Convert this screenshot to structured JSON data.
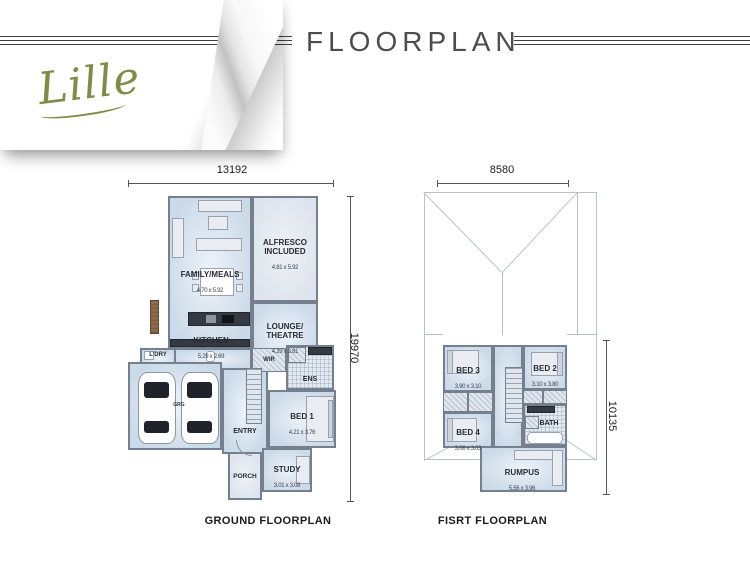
{
  "header": {
    "logo": "Lille",
    "title": "FLOORPLAN"
  },
  "ground": {
    "caption": "GROUND FLOORPLAN",
    "dim_width": "13192",
    "dim_height": "19970",
    "rooms": {
      "family": {
        "name": "FAMILY/MEALS",
        "dim": "4.70 x 5.92"
      },
      "alfresco": {
        "name": "ALFRESCO\nINCLUDED",
        "dim": "4.81 x 5.92"
      },
      "lounge": {
        "name": "LOUNGE/\nTHEATRE",
        "dim": "4.29 x 3.81"
      },
      "kitchen": {
        "name": "KITCHEN",
        "dim": "5.29 x 2.69"
      },
      "ldry": {
        "name": "L'DRY"
      },
      "wir": {
        "name": "WIR"
      },
      "ens": {
        "name": "ENS"
      },
      "bed1": {
        "name": "BED 1",
        "dim": "4.21 x 3.76"
      },
      "entry": {
        "name": "ENTRY"
      },
      "study": {
        "name": "STUDY",
        "dim": "3.01 x 3.08"
      },
      "porch": {
        "name": "PORCH"
      },
      "garage": {
        "name": "GRG"
      }
    }
  },
  "first": {
    "caption": "FISRT FLOORPLAN",
    "dim_width": "8580",
    "dim_height": "10135",
    "rooms": {
      "bed3": {
        "name": "BED 3",
        "dim": "3.90 x 3.10"
      },
      "bed2": {
        "name": "BED 2",
        "dim": "3.10 x 3.80"
      },
      "bed4": {
        "name": "BED 4",
        "dim": "3.06 x 3.03"
      },
      "bath": {
        "name": "BATH"
      },
      "rumpus": {
        "name": "RUMPUS",
        "dim": "5.56 x 3.96"
      }
    }
  }
}
